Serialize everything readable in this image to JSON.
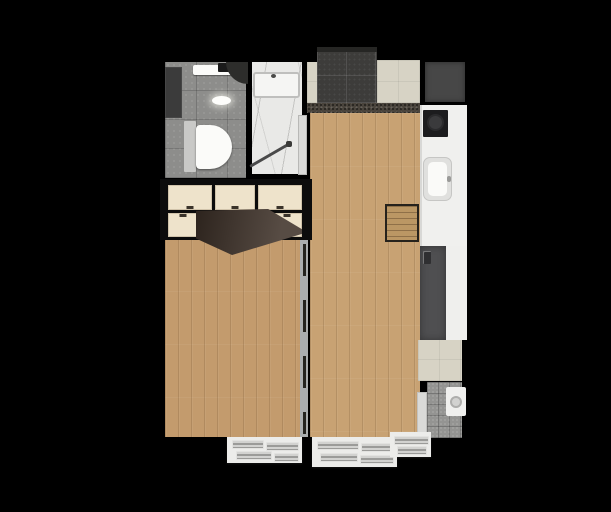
{
  "scene": {
    "type": "apartment-floor-plan-top-view",
    "description": "rendered floor plan, no text labels",
    "background": "#000000"
  },
  "plan": {
    "colors": {
      "wall": "#0a0a0a",
      "wood_living": "#c8a273",
      "wood_bedroom": "#c39b6d",
      "tile_gray": "#8d8d8b",
      "tile_dark_entry": "#3d3c3a",
      "tile_beige": "#d7d3c5",
      "marble_white": "#e9e9e7",
      "counter_white": "#f0f0ee",
      "counter_low_white": "#efefed",
      "wardrobe_cream": "#eee3cb",
      "wardrobe_open_door_brown": "#40332a",
      "fridge_dark": "#4f4f51",
      "shaft_gray": "#474747",
      "shelf_dark": "#3b3b3b",
      "fixture_white": "#fbfbf9",
      "cistern_gray": "#c9c9c7",
      "tub_white": "#f5f5f3",
      "cooktop_black": "#1c1c1e",
      "sink_gray": "#e0e0de",
      "door_white": "#dadad8",
      "door_swing_dark": "#2d2d2b",
      "entry_door_dark": "#262624",
      "threshold_brown": "#4a443c",
      "partition_track_gray": "#a9adaf",
      "partition_dash_dark": "#23231f",
      "utility_gray": "#949492",
      "washer_white": "#f0f0ee",
      "window_white": "#ececea",
      "niche_black": "#0c0c0c",
      "screen_gray": "#4a4a4a"
    },
    "rooms": [
      {
        "name": "bathroom-toilet-area"
      },
      {
        "name": "bathroom-shower-area"
      },
      {
        "name": "entry-hall"
      },
      {
        "name": "kitchen"
      },
      {
        "name": "living-room"
      },
      {
        "name": "bedroom"
      },
      {
        "name": "utility-balcony"
      }
    ],
    "fixtures": [
      "toilet",
      "toilet-cistern",
      "vanity-sink",
      "ceiling-light",
      "bathtub",
      "shower-screen",
      "bathroom-door",
      "door-swing",
      "wardrobe",
      "wardrobe-open-doors",
      "service-shaft",
      "kitchen-counter",
      "cooktop",
      "kitchen-sink",
      "dining-table",
      "refrigerator",
      "washing-machine",
      "utility-door",
      "sliding-partition",
      "window-vent-1",
      "window-vent-2",
      "window-vent-3",
      "side-shelf",
      "entry-threshold"
    ]
  }
}
